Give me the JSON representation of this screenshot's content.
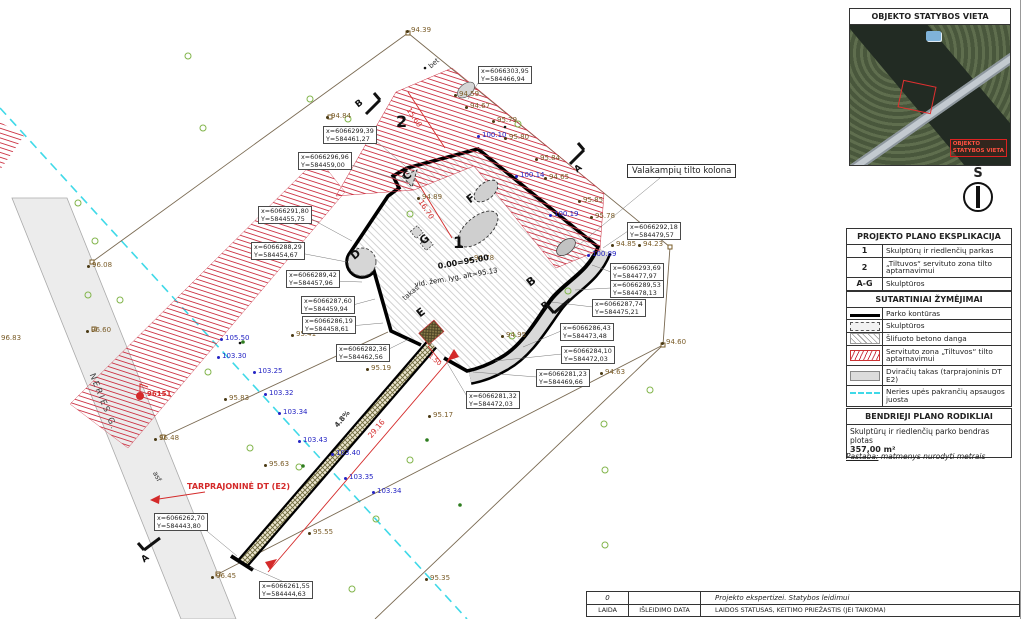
{
  "inset": {
    "title": "OBJEKTO STATYBOS VIETA",
    "tag_line1": "OBJEKTO",
    "tag_line2": "STATYBOS VIETA",
    "north": "Š"
  },
  "explication": {
    "title": "PROJEKTO PLANO EKSPLIKACIJA",
    "rows": [
      {
        "key": "1",
        "label": "Skulptūrų ir riedlenčių parkas"
      },
      {
        "key": "2",
        "label": "„Tiltuvos“ servituto zona tilto aptarnavimui"
      },
      {
        "key": "A-G",
        "label": "Skulptūros"
      }
    ]
  },
  "legend": {
    "title": "SUTARTINIAI ŽYMĖJIMAI",
    "items": [
      {
        "symbol": "park-contour-line",
        "label": "Parko kontūras"
      },
      {
        "symbol": "sculpture-dashed-rect",
        "label": "Skulptūros"
      },
      {
        "symbol": "polished-concrete-hatch",
        "label": "Šlifuoto betono danga"
      },
      {
        "symbol": "servitude-red-hatch",
        "label": "Servituto zona „Tiltuvos“ tilto aptarnavimui"
      },
      {
        "symbol": "bike-path-gray",
        "label": "Dviračių takas (tarprajoninis DT E2)"
      },
      {
        "symbol": "river-protection-dashed",
        "label": "Neries upės pakrančių apsaugos juosta"
      }
    ]
  },
  "indicators": {
    "title": "BENDRIEJI PLANO RODIKLIAI",
    "line1": "Skulptūrų ir riedlenčių parko bendras plotas",
    "value": "357,00 m²",
    "note_label": "Pastaba:",
    "note_text": " matmenys nurodyti metrais"
  },
  "titleblock": {
    "rev": "0",
    "desc": "Projekto ekspertizei. Statybos leidimui",
    "c1": "LAIDA",
    "c2": "IŠLEIDIMO DATA",
    "c3": "LAIDOS STATUSAS, KEITIMO PRIEŽASTIS (JEI TAIKOMA)"
  },
  "plan": {
    "zone1": "1",
    "zone2": "2",
    "letters": {
      "c": "C",
      "d": "D",
      "e": "E",
      "f": "F",
      "g": "G",
      "b": "B"
    },
    "sections": {
      "a": "A",
      "b": "B"
    },
    "level": "0.00=95.00",
    "avg_level": "vid. žem. lyg. alt=95.13",
    "takas": "takas",
    "bet": "bet",
    "asf": "asf",
    "street": "NERIES G.",
    "bridge_callout": "Valakampių tilto kolona",
    "red_route": "TARPRAJONINĖ DT (E2)",
    "red_point": "96151",
    "dims": {
      "d1": "15.60",
      "d2": "16.70",
      "d3": "29.16",
      "d4": "1.50",
      "slope": "4.8%"
    },
    "coords": [
      {
        "x": "x=6066303,95",
        "y": "Y=584466,94"
      },
      {
        "x": "x=6066299,39",
        "y": "Y=584461,27"
      },
      {
        "x": "x=6066296,96",
        "y": "Y=584459,00"
      },
      {
        "x": "x=6066291,80",
        "y": "Y=584455,75"
      },
      {
        "x": "x=6066288,29",
        "y": "Y=584454,67"
      },
      {
        "x": "x=6066289,42",
        "y": "Y=584457,96"
      },
      {
        "x": "x=6066287,60",
        "y": "Y=584459,94"
      },
      {
        "x": "x=6066286,19",
        "y": "Y=584458,61"
      },
      {
        "x": "x=6066282,36",
        "y": "Y=584462,56"
      },
      {
        "x": "x=6066262,70",
        "y": "Y=584443,80"
      },
      {
        "x": "x=6066261,55",
        "y": "Y=584444,63"
      },
      {
        "x": "x=6066281,32",
        "y": "Y=584472,03"
      },
      {
        "x": "x=6066281,23",
        "y": "Y=584469,66"
      },
      {
        "x": "x=6066284,10",
        "y": "Y=584472,03"
      },
      {
        "x": "x=6066286,43",
        "y": "Y=584473,48"
      },
      {
        "x": "x=6066287,74",
        "y": "Y=584475,21"
      },
      {
        "x": "x=6066289,53",
        "y": "Y=584478,13"
      },
      {
        "x": "x=6066293,69",
        "y": "Y=584477,97"
      },
      {
        "x": "x=6066292,18",
        "y": "Y=584479,57"
      }
    ],
    "spots_brown": [
      {
        "v": "94.39"
      },
      {
        "v": "94.84"
      },
      {
        "v": "94.59"
      },
      {
        "v": "94.67"
      },
      {
        "v": "95.79"
      },
      {
        "v": "95.80"
      },
      {
        "v": "95.84"
      },
      {
        "v": "94.65"
      },
      {
        "v": "95.85"
      },
      {
        "v": "95.78"
      },
      {
        "v": "94.85"
      },
      {
        "v": "94.23"
      },
      {
        "v": "94.60"
      },
      {
        "v": "94.63"
      },
      {
        "v": "94.89"
      },
      {
        "v": "94.78"
      },
      {
        "v": "94.95"
      },
      {
        "v": "95.17"
      },
      {
        "v": "95.19"
      },
      {
        "v": "95.41"
      },
      {
        "v": "95.83"
      },
      {
        "v": "95.55"
      },
      {
        "v": "96.45"
      },
      {
        "v": "96.48"
      },
      {
        "v": "96.60"
      },
      {
        "v": "96.83"
      },
      {
        "v": "96.08"
      },
      {
        "v": "95.63"
      },
      {
        "v": "95.35"
      }
    ],
    "spots_blue": [
      {
        "v": "105.50"
      },
      {
        "v": "103.30"
      },
      {
        "v": "103.25"
      },
      {
        "v": "103.32"
      },
      {
        "v": "103.34"
      },
      {
        "v": "103.43"
      },
      {
        "v": "103.40"
      },
      {
        "v": "103.35"
      },
      {
        "v": "103.34"
      },
      {
        "v": "100.10"
      },
      {
        "v": "100.14"
      },
      {
        "v": "100.19"
      },
      {
        "v": "100.89"
      }
    ]
  }
}
